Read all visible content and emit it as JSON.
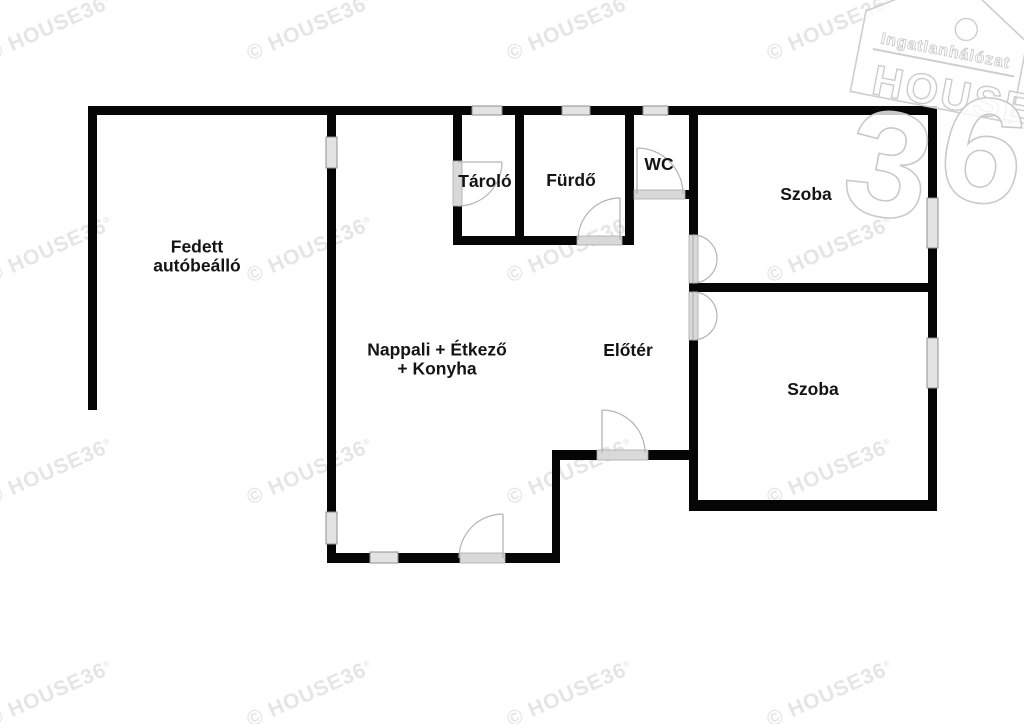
{
  "image": {
    "width": 1024,
    "height": 724,
    "background": "#ffffff"
  },
  "colors": {
    "wall": "#060606",
    "window_fill": "#e3e3e3",
    "window_stroke": "#8f8f8f",
    "threshold_fill": "#d9d9d9",
    "threshold_stroke": "#ababab",
    "door_arc": "#b3b3b3",
    "label": "#141414",
    "watermark": "#e5e5e5",
    "logo_stroke": "#cecece",
    "logo_fill": "rgba(255,255,255,0.78)"
  },
  "rooms": [
    {
      "name": "room-label-carport",
      "lines": [
        "Fedett",
        "autóbeálló"
      ],
      "cx": 197,
      "cy": 256
    },
    {
      "name": "room-label-storage",
      "lines": [
        "Tároló"
      ],
      "cx": 485,
      "cy": 181
    },
    {
      "name": "room-label-bath",
      "lines": [
        "Fürdő"
      ],
      "cx": 571,
      "cy": 180
    },
    {
      "name": "room-label-wc",
      "lines": [
        "WC"
      ],
      "cx": 659,
      "cy": 164
    },
    {
      "name": "room-label-room1",
      "lines": [
        "Szoba"
      ],
      "cx": 806,
      "cy": 194
    },
    {
      "name": "room-label-room2",
      "lines": [
        "Szoba"
      ],
      "cx": 813,
      "cy": 389
    },
    {
      "name": "room-label-living",
      "lines": [
        "Nappali + Étkező",
        "+ Konyha"
      ],
      "cx": 437,
      "cy": 359
    },
    {
      "name": "room-label-hall",
      "lines": [
        "Előtér"
      ],
      "cx": 628,
      "cy": 350
    }
  ],
  "label_style": {
    "font_size": 17.5,
    "line_height": 19
  },
  "walls": [
    {
      "name": "top-wall-1",
      "rect": [
        88,
        106,
        384,
        9
      ]
    },
    {
      "name": "top-wall-2",
      "rect": [
        502,
        106,
        60,
        9
      ]
    },
    {
      "name": "top-wall-3",
      "rect": [
        590,
        106,
        53,
        9
      ]
    },
    {
      "name": "top-wall-4",
      "rect": [
        668,
        106,
        269,
        9
      ]
    },
    {
      "name": "carport-left-wall",
      "rect": [
        88,
        106,
        9,
        304
      ]
    },
    {
      "name": "living-left-wall-1",
      "rect": [
        327,
        106,
        9,
        31
      ]
    },
    {
      "name": "living-left-wall-2",
      "rect": [
        327,
        168,
        9,
        344
      ]
    },
    {
      "name": "living-left-wall-3",
      "rect": [
        327,
        544,
        9,
        19
      ]
    },
    {
      "name": "storage-left-wall-1",
      "rect": [
        453,
        106,
        9,
        55
      ]
    },
    {
      "name": "storage-left-wall-2",
      "rect": [
        453,
        206,
        9,
        39
      ]
    },
    {
      "name": "storage-bath-divider",
      "rect": [
        515,
        106,
        9,
        139
      ]
    },
    {
      "name": "bath-bottom-wall-1",
      "rect": [
        453,
        236,
        124,
        9
      ]
    },
    {
      "name": "bath-bottom-wall-2",
      "rect": [
        622,
        236,
        12,
        9
      ]
    },
    {
      "name": "bath-wc-divider",
      "rect": [
        625,
        106,
        9,
        139
      ]
    },
    {
      "name": "wc-bottom-stub",
      "rect": [
        685,
        190,
        13,
        9
      ]
    },
    {
      "name": "hall-right-wall-1",
      "rect": [
        689,
        106,
        9,
        129
      ]
    },
    {
      "name": "hall-right-wall-2",
      "rect": [
        689,
        283,
        9,
        9
      ]
    },
    {
      "name": "hall-right-wall-3",
      "rect": [
        689,
        340,
        9,
        171
      ]
    },
    {
      "name": "rooms-divider-wall",
      "rect": [
        698,
        283,
        230,
        9
      ]
    },
    {
      "name": "right-wall-1",
      "rect": [
        928,
        106,
        9,
        92
      ]
    },
    {
      "name": "right-wall-2",
      "rect": [
        928,
        248,
        9,
        90
      ]
    },
    {
      "name": "right-wall-3",
      "rect": [
        928,
        388,
        9,
        123
      ]
    },
    {
      "name": "room2-bottom-wall",
      "rect": [
        689,
        500,
        248,
        11
      ]
    },
    {
      "name": "hall-bottom-wall-1",
      "rect": [
        552,
        450,
        45,
        10
      ]
    },
    {
      "name": "hall-bottom-wall-2",
      "rect": [
        648,
        450,
        41,
        10
      ]
    },
    {
      "name": "step-wall",
      "rect": [
        552,
        450,
        8,
        113
      ]
    },
    {
      "name": "living-bottom-wall-1",
      "rect": [
        327,
        553,
        43,
        10
      ]
    },
    {
      "name": "living-bottom-wall-2",
      "rect": [
        398,
        553,
        62,
        10
      ]
    },
    {
      "name": "living-bottom-wall-3",
      "rect": [
        505,
        553,
        55,
        10
      ]
    }
  ],
  "windows": [
    {
      "name": "window-top-storage",
      "rect": [
        472,
        106,
        30,
        9
      ]
    },
    {
      "name": "window-top-bath",
      "rect": [
        562,
        106,
        28,
        9
      ]
    },
    {
      "name": "window-top-wc",
      "rect": [
        643,
        106,
        25,
        9
      ]
    },
    {
      "name": "window-carport-east",
      "rect": [
        326,
        137,
        11,
        31
      ]
    },
    {
      "name": "window-living-west",
      "rect": [
        326,
        512,
        11,
        32
      ]
    },
    {
      "name": "window-room1-east",
      "rect": [
        927,
        198,
        11,
        50
      ]
    },
    {
      "name": "window-room2-east",
      "rect": [
        927,
        338,
        11,
        50
      ]
    },
    {
      "name": "window-living-south",
      "rect": [
        370,
        552,
        28,
        11
      ]
    }
  ],
  "thresholds": [
    {
      "name": "threshold-storage",
      "rect": [
        453,
        161,
        9,
        45
      ]
    },
    {
      "name": "threshold-bath",
      "rect": [
        577,
        236,
        45,
        9
      ]
    },
    {
      "name": "threshold-wc",
      "rect": [
        634,
        190,
        51,
        9
      ]
    },
    {
      "name": "threshold-room1",
      "rect": [
        689,
        235,
        9,
        48
      ]
    },
    {
      "name": "threshold-room2",
      "rect": [
        689,
        292,
        9,
        48
      ]
    },
    {
      "name": "threshold-entrance",
      "rect": [
        597,
        450,
        51,
        10
      ]
    },
    {
      "name": "threshold-terrace",
      "rect": [
        460,
        553,
        45,
        10
      ]
    }
  ],
  "doors": [
    {
      "name": "door-storage",
      "leaf": [
        458,
        162,
        502,
        162
      ],
      "arc": "M502,162 A44,44 0 0 1 458,206"
    },
    {
      "name": "door-bath",
      "leaf": [
        620,
        240,
        620,
        198
      ],
      "arc": "M578,240 A42,42 0 0 1 620,198"
    },
    {
      "name": "door-wc",
      "leaf": [
        637,
        194,
        637,
        148
      ],
      "arc": "M637,148 A46,46 0 0 1 683,194"
    },
    {
      "name": "door-room1",
      "leaf": [
        693,
        235,
        693,
        283
      ],
      "arc": "M693,235 A24,24 0 0 1 693,283"
    },
    {
      "name": "door-room2",
      "leaf": [
        693,
        292,
        693,
        340
      ],
      "arc": "M693,292 A24,24 0 0 1 693,340"
    },
    {
      "name": "door-entrance",
      "leaf": [
        602,
        453,
        602,
        410
      ],
      "arc": "M602,410 A43,43 0 0 1 645,453"
    },
    {
      "name": "door-terrace",
      "leaf": [
        503,
        558,
        503,
        514
      ],
      "arc": "M503,514 A44,44 0 0 0 459,558"
    }
  ],
  "watermark": {
    "text": "© HOUSE36",
    "reg_mark": "®",
    "angle_deg": -24,
    "font_size": 21,
    "columns_x": [
      50,
      310,
      570,
      830
    ],
    "rows_y": [
      28,
      250,
      472,
      694
    ]
  },
  "logo": {
    "network_label": "Ingatlanhálózat",
    "brand_word": "HOUSE",
    "digits": [
      "3",
      "6"
    ]
  }
}
